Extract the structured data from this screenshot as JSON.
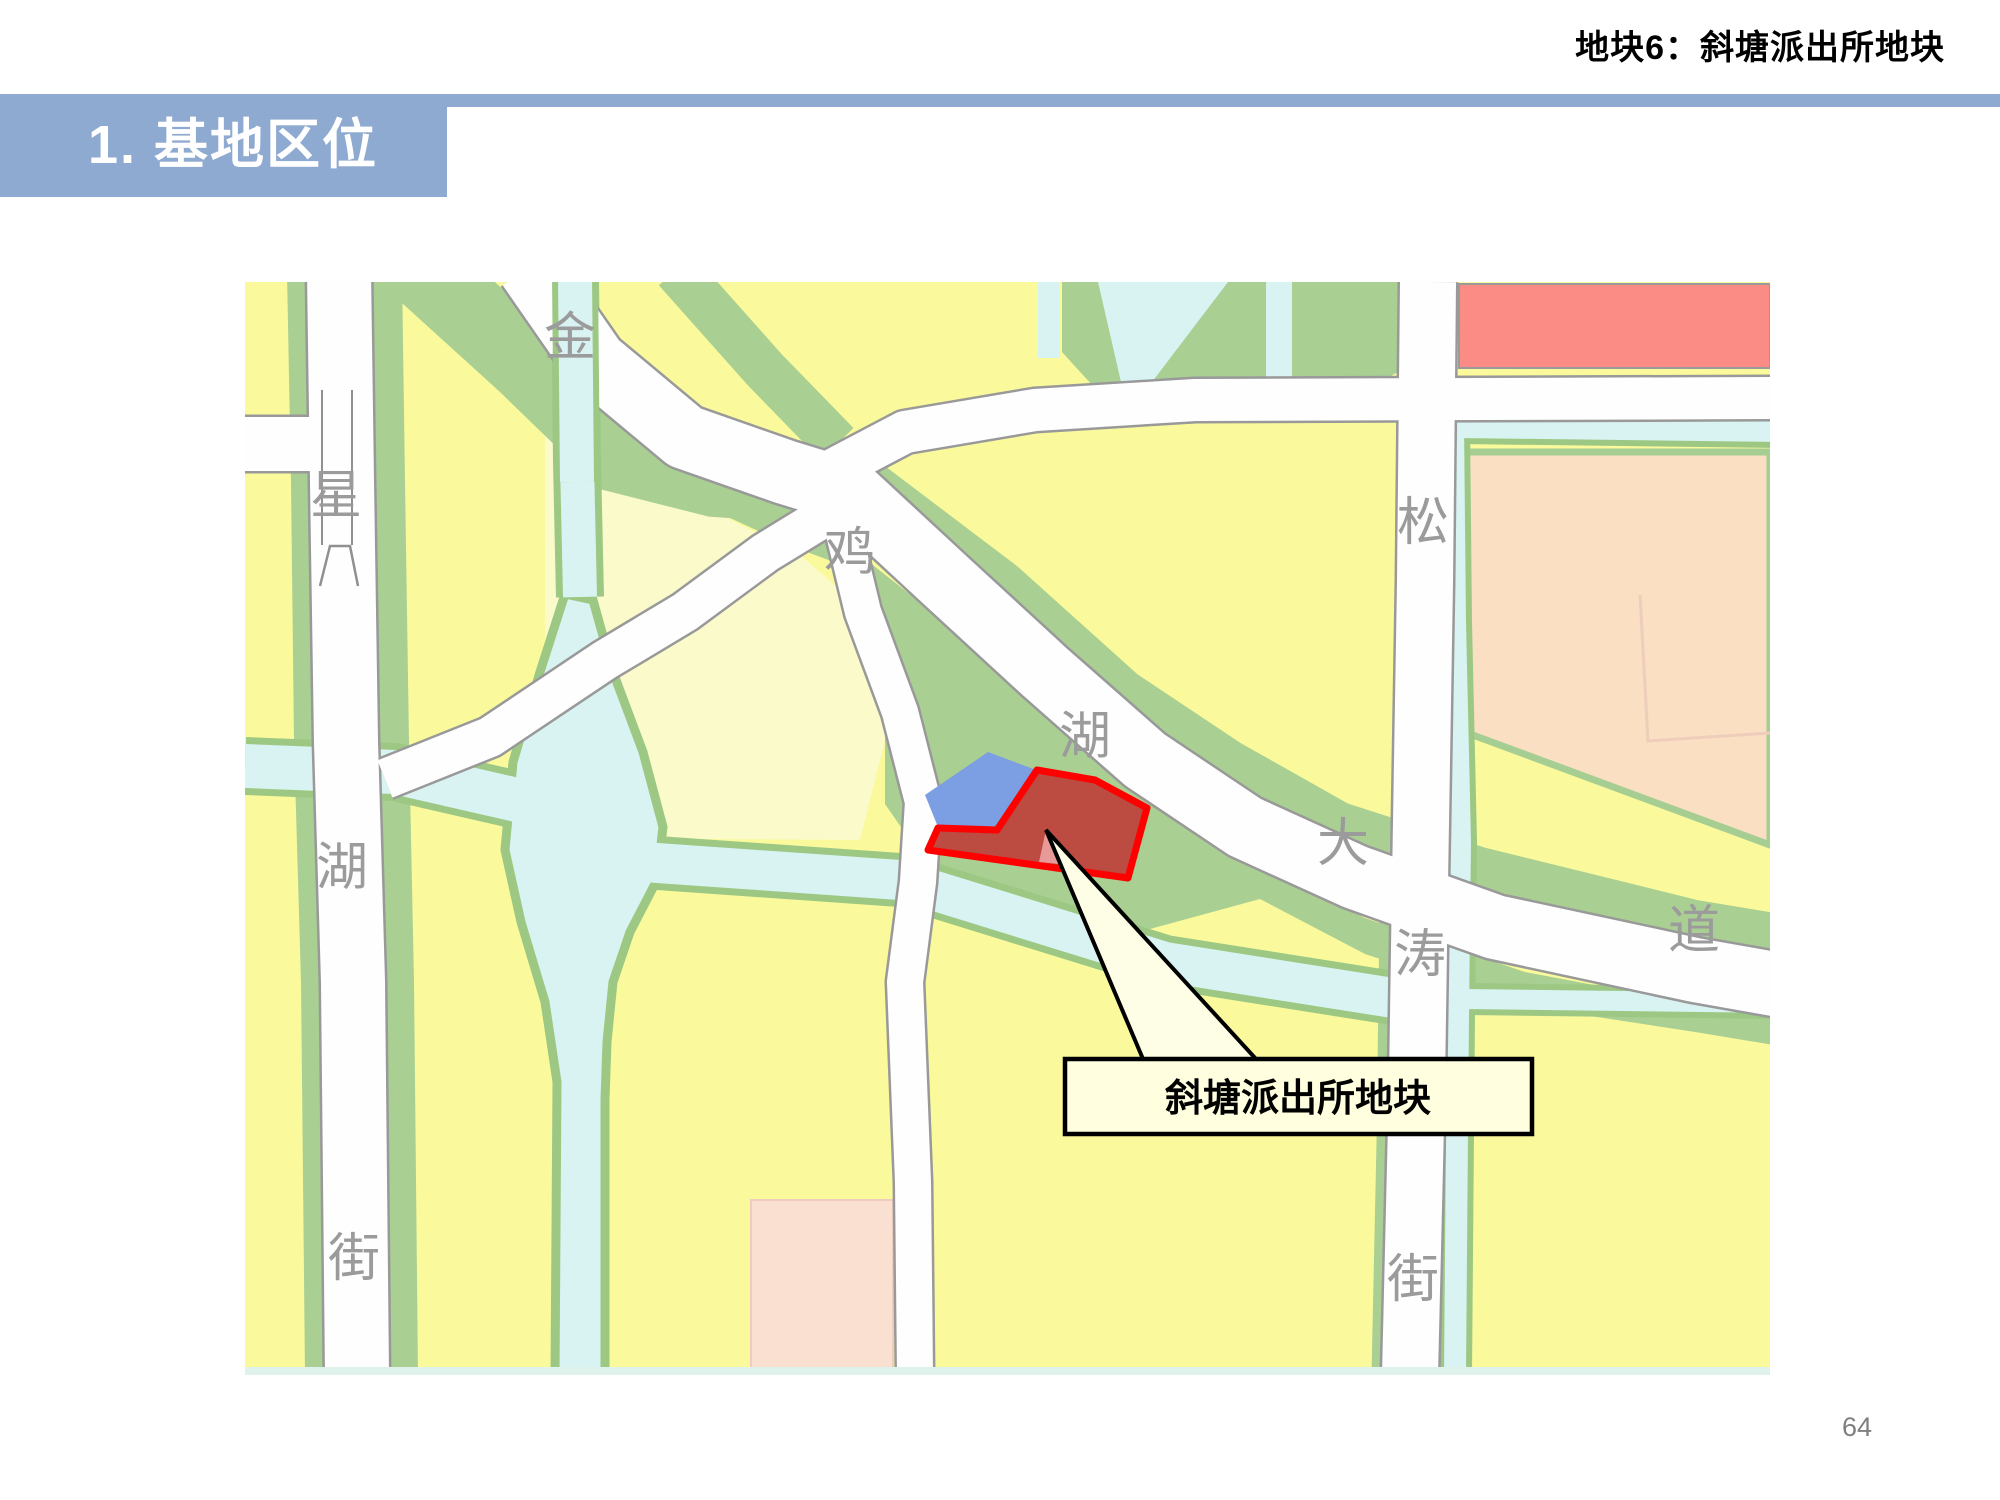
{
  "header": {
    "title": "地块6：斜塘派出所地块"
  },
  "section": {
    "title": "1. 基地区位"
  },
  "page": {
    "number": "64"
  },
  "map": {
    "roads": {
      "jinjihu_avenue": {
        "name": "金鸡湖大道",
        "chars": [
          "金",
          "鸡",
          "湖",
          "大",
          "道"
        ]
      },
      "xinghu_street": {
        "name": "星湖街",
        "chars": [
          "星",
          "湖",
          "街"
        ]
      },
      "songtao_street": {
        "name": "松涛街",
        "chars": [
          "松",
          "涛",
          "街"
        ]
      }
    },
    "callout": {
      "label": "斜塘派出所地块"
    },
    "site": {
      "name": "斜塘派出所地块"
    }
  },
  "colors": {
    "accent_blue": "#8FAAD0",
    "map_yellow": "#FAFA9C",
    "map_cream": "#FAFACB",
    "map_green": "#A9CF92",
    "water_cyan": "#D8F3F1",
    "road_white": "#FEFEFE",
    "parcel_orange": "#FADFC3",
    "parcel_coral": "#FB8B85",
    "parcel_pink": "#FAE0D0",
    "parcel_blue": "#7C9EE3",
    "site_fill": "#BC4B41",
    "site_border": "#FF0000",
    "callout_fill": "#FFFFE0",
    "street_label_gray": "#9B9B9B"
  }
}
